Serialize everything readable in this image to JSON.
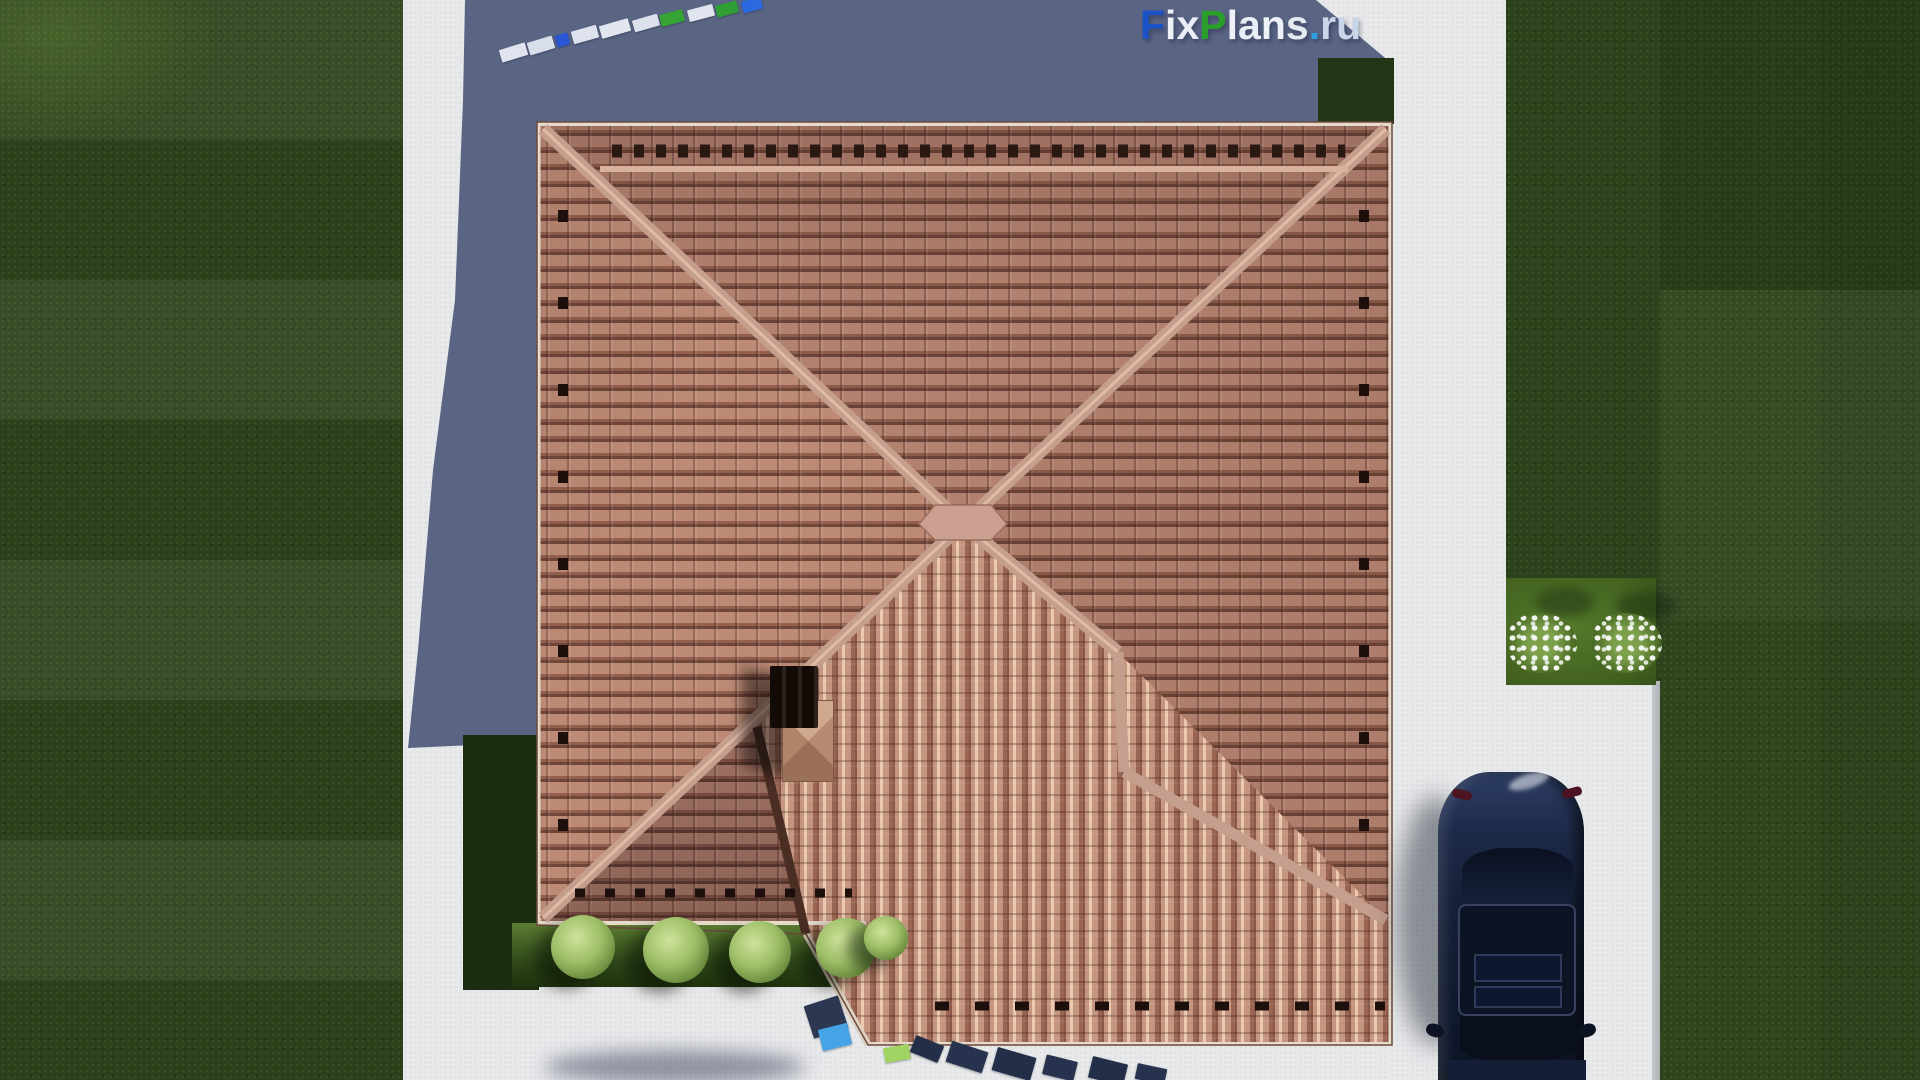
{
  "logo": {
    "text": "FixPlans.ru",
    "chars": [
      {
        "ch": "F",
        "color": "#1a52c8"
      },
      {
        "ch": "i",
        "color": "#eef2f8"
      },
      {
        "ch": "x",
        "color": "#e9edf5"
      },
      {
        "ch": "P",
        "color": "#2aa02a"
      },
      {
        "ch": "l",
        "color": "#eef2f8"
      },
      {
        "ch": "a",
        "color": "#e9edf5"
      },
      {
        "ch": "n",
        "color": "#eef2f8"
      },
      {
        "ch": "s",
        "color": "#e4e9f2"
      },
      {
        "ch": ".",
        "color": "#2f9fe6"
      },
      {
        "ch": "r",
        "color": "#c9d6ea"
      },
      {
        "ch": "u",
        "color": "#c9d6ea"
      }
    ]
  },
  "palette": {
    "grass": "#2e451d",
    "grass_shadowed": "#1c2e12",
    "pavement": "#e8e9eb",
    "house_shadow": "#5a6584",
    "roof_tile": "#b3806e",
    "roof_tile_bright": "#d8ae94",
    "ridge": "#c59e8e",
    "fascia": "#e6dacb",
    "car_body": "#16203a",
    "bush_green": "#9cbd66",
    "flower_white": "#f3f6f0",
    "logo_blue": "#1a52c8",
    "logo_green": "#2aa02a",
    "logo_cyan": "#2f9fe6"
  },
  "watermark3d": {
    "top_row": [
      {
        "x": 500,
        "y": 46,
        "w": 27,
        "h": 13,
        "rot": -17,
        "color": "#dfe4ee"
      },
      {
        "x": 528,
        "y": 39,
        "w": 26,
        "h": 13,
        "rot": -17,
        "color": "#d8deea"
      },
      {
        "x": 556,
        "y": 34,
        "w": 13,
        "h": 12,
        "rot": -17,
        "color": "#2b57d6"
      },
      {
        "x": 572,
        "y": 28,
        "w": 26,
        "h": 13,
        "rot": -16,
        "color": "#dde2ec"
      },
      {
        "x": 600,
        "y": 22,
        "w": 30,
        "h": 13,
        "rot": -16,
        "color": "#e2e6ef"
      },
      {
        "x": 633,
        "y": 17,
        "w": 26,
        "h": 12,
        "rot": -16,
        "color": "#dce1eb"
      },
      {
        "x": 660,
        "y": 12,
        "w": 24,
        "h": 12,
        "rot": -15,
        "color": "#35a435"
      },
      {
        "x": 688,
        "y": 7,
        "w": 26,
        "h": 12,
        "rot": -15,
        "color": "#dfe4ee"
      },
      {
        "x": 716,
        "y": 3,
        "w": 22,
        "h": 12,
        "rot": -15,
        "color": "#2f9e35"
      },
      {
        "x": 742,
        "y": -1,
        "w": 20,
        "h": 12,
        "rot": -15,
        "color": "#2b6ade"
      }
    ],
    "bottom_row": [
      {
        "x": 808,
        "y": 1000,
        "w": 36,
        "h": 34,
        "rot": -18,
        "color": "#2c3852"
      },
      {
        "x": 820,
        "y": 1026,
        "w": 30,
        "h": 22,
        "rot": -14,
        "color": "#45a3e6"
      },
      {
        "x": 884,
        "y": 1046,
        "w": 26,
        "h": 15,
        "rot": -10,
        "color": "#a2d464"
      },
      {
        "x": 912,
        "y": 1040,
        "w": 30,
        "h": 18,
        "rot": 22,
        "color": "#232e48"
      },
      {
        "x": 948,
        "y": 1046,
        "w": 38,
        "h": 22,
        "rot": 18,
        "color": "#27324e"
      },
      {
        "x": 994,
        "y": 1052,
        "w": 40,
        "h": 24,
        "rot": 16,
        "color": "#232e48"
      },
      {
        "x": 1044,
        "y": 1058,
        "w": 32,
        "h": 20,
        "rot": 14,
        "color": "#27324e"
      },
      {
        "x": 1090,
        "y": 1060,
        "w": 36,
        "h": 22,
        "rot": 14,
        "color": "#232e48"
      },
      {
        "x": 1136,
        "y": 1066,
        "w": 30,
        "h": 16,
        "rot": 12,
        "color": "#27324e"
      }
    ]
  },
  "garden": {
    "bushes": [
      {
        "x": 583,
        "y": 947,
        "r": 32
      },
      {
        "x": 676,
        "y": 950,
        "r": 33
      },
      {
        "x": 760,
        "y": 952,
        "r": 31
      },
      {
        "x": 846,
        "y": 948,
        "r": 30
      },
      {
        "x": 886,
        "y": 938,
        "r": 22
      }
    ],
    "flowers": [
      {
        "x": 1542,
        "y": 643
      },
      {
        "x": 1627,
        "y": 643
      }
    ],
    "flower_shadows": [
      {
        "x": 1565,
        "y": 602
      },
      {
        "x": 1646,
        "y": 606
      }
    ]
  }
}
